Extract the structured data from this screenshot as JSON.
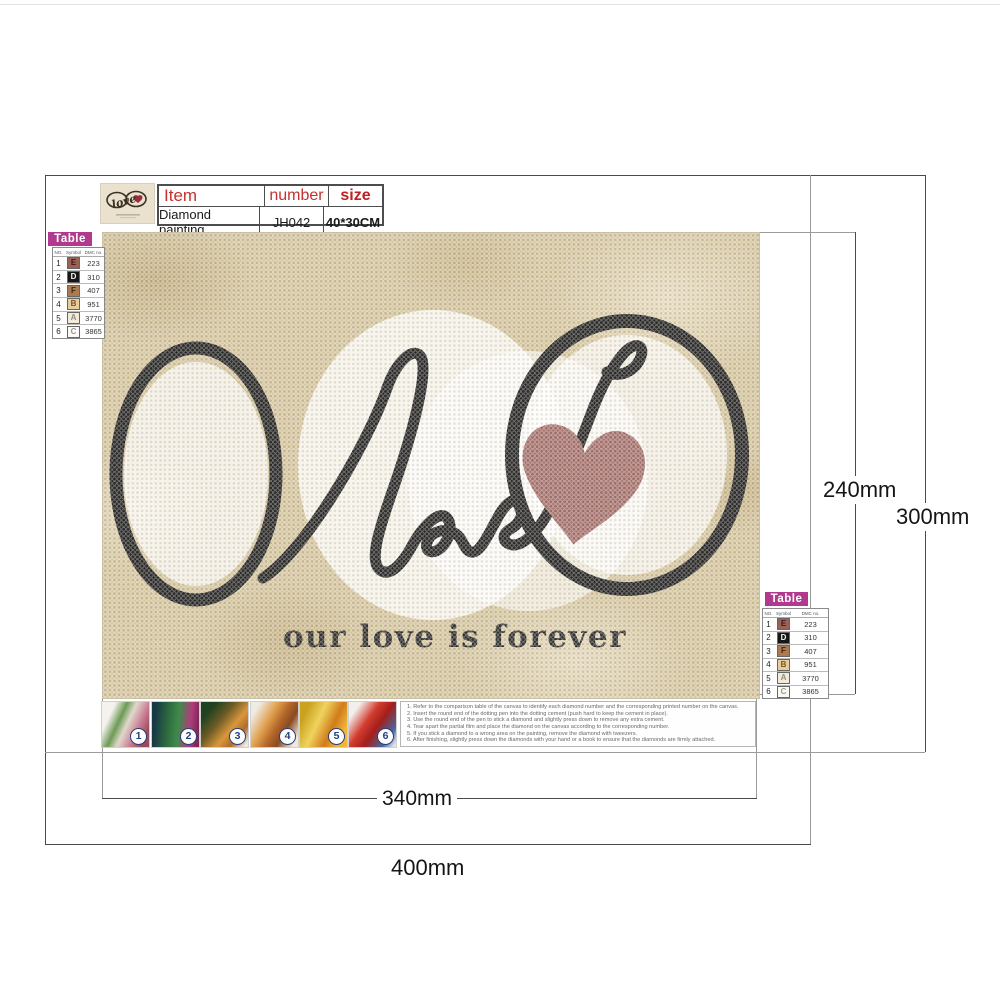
{
  "brand": {
    "logo_word": "love"
  },
  "info_table": {
    "headers": [
      "Item",
      "number",
      "size"
    ],
    "values": [
      "Diamond painting",
      "JH042",
      "40*30CM"
    ]
  },
  "legend": {
    "title": "Table",
    "columns": [
      "NO.",
      "Symbol",
      "DMC no."
    ],
    "rows": [
      {
        "no": "1",
        "symbol": "E",
        "code": "223",
        "bg": "#9a6157",
        "fg": "#3d1b16"
      },
      {
        "no": "2",
        "symbol": "D",
        "code": "310",
        "bg": "#161616",
        "fg": "#f5f5f5"
      },
      {
        "no": "3",
        "symbol": "F",
        "code": "407",
        "bg": "#ab7a50",
        "fg": "#3d2410"
      },
      {
        "no": "4",
        "symbol": "B",
        "code": "951",
        "bg": "#e7cd9e",
        "fg": "#77541f"
      },
      {
        "no": "5",
        "symbol": "A",
        "code": "3770",
        "bg": "#f3ebd7",
        "fg": "#8f8d80"
      },
      {
        "no": "6",
        "symbol": "C",
        "code": "3865",
        "bg": "#fcfaf4",
        "fg": "#9a988e"
      }
    ]
  },
  "canvas": {
    "center_word": "love",
    "bottom_text": "our love is forever",
    "colors": {
      "background": "#d5c6a0",
      "line": "#242424",
      "heart": "#a5716d"
    }
  },
  "dimensions": {
    "inner_width": "340mm",
    "outer_width": "400mm",
    "inner_height": "240mm",
    "outer_height": "300mm"
  },
  "steps": [
    "1",
    "2",
    "3",
    "4",
    "5",
    "6"
  ],
  "instructions": [
    "1. Refer to the comparison table of the canvas to identify each diamond number and the corresponding printed number on the canvas.",
    "2. Insert the round end of the dotting pen into the dotting cement (push hard to keep the cement in place).",
    "3. Use the round end of the pen to stick a diamond and slightly press down to remove any extra cement.",
    "4. Tear apart the partial film and place the diamond on the canvas according to the corresponding number.",
    "5. If you stick a diamond to a wrong area on the painting, remove the diamond with tweezers.",
    "6. After finishing, slightly press down the diamonds with your hand or a book to ensure that the diamonds are firmly attached."
  ]
}
